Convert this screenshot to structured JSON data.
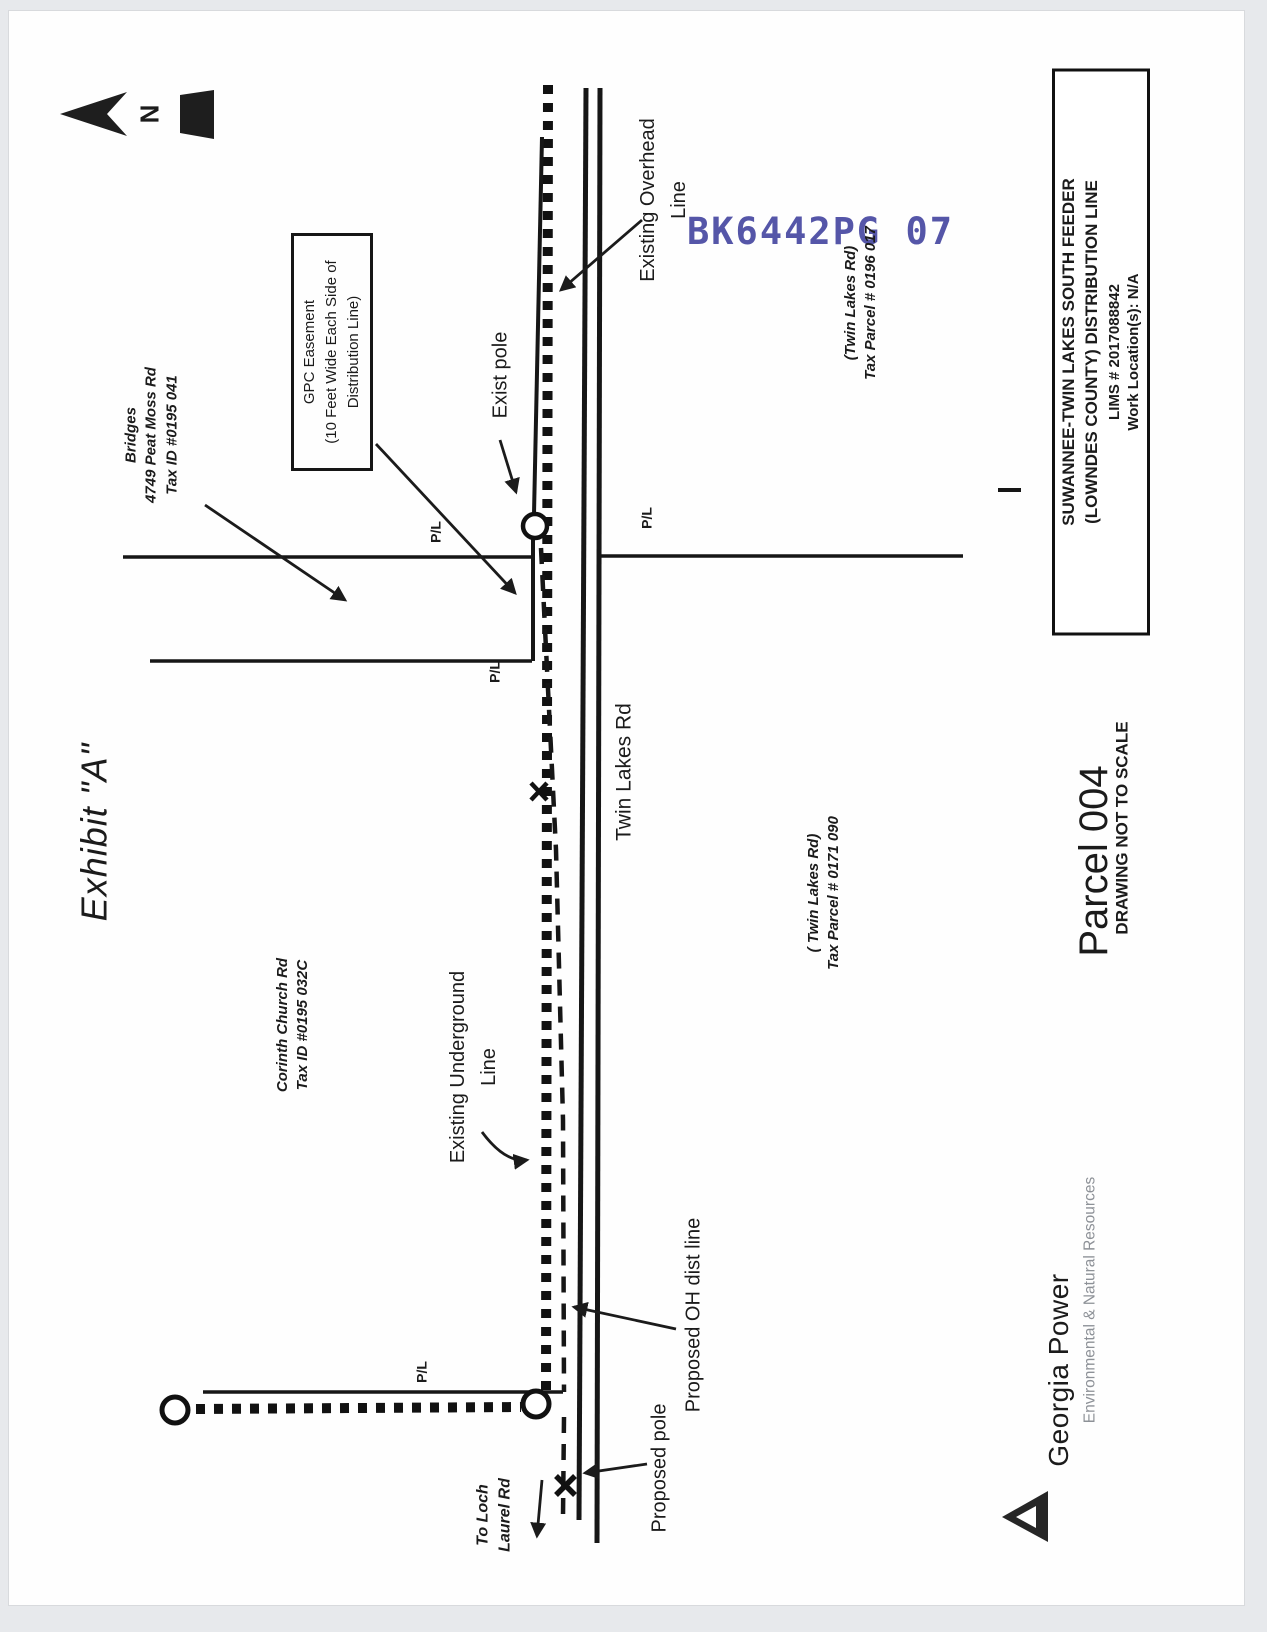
{
  "exhibit": {
    "title": "Exhibit \"A\""
  },
  "compass": {
    "n": "N"
  },
  "stamp": {
    "text": "BK6442PG 07"
  },
  "easement_note": {
    "l1": "GPC  Easement",
    "l2": "(10 Feet Wide Each Side of",
    "l3": "Distribution Line)"
  },
  "labels": {
    "exist_pole": "Exist pole",
    "existing_overhead_1": "Existing Overhead",
    "existing_overhead_2": "Line",
    "existing_underground_1": "Existing Underground",
    "existing_underground_2": "Line",
    "proposed_oh": "Proposed  OH dist line",
    "proposed_pole": "Proposed pole",
    "to_loch_1": "To Loch",
    "to_loch_2": "Laurel Rd",
    "pl": "P/L",
    "road_name": "Twin Lakes Rd"
  },
  "parcels": {
    "bridges": {
      "l1": "Bridges",
      "l2": "4749 Peat Moss Rd",
      "l3": "Tax ID #0195 041"
    },
    "corinth": {
      "l1": "Corinth Church Rd",
      "l2": "Tax ID #0195 032C"
    },
    "tl_0196": {
      "l1": "(Twin Lakes Rd)",
      "l2": "Tax Parcel # 0196 017"
    },
    "tl_0171": {
      "l1": "( Twin Lakes Rd)",
      "l2": "Tax Parcel # 0171 090"
    }
  },
  "title_block": {
    "l1": "SUWANNEE-TWIN LAKES SOUTH FEEDER",
    "l2": "(LOWNDES COUNTY) DISTRIBUTION LINE",
    "l3": "LIMS # 2017088842",
    "l4": "Work Location(s): N/A"
  },
  "footer": {
    "parcel": "Parcel 004",
    "scale_note": "DRAWING NOT TO SCALE",
    "brand": "Georgia Power",
    "department": "Environmental & Natural Resources"
  }
}
